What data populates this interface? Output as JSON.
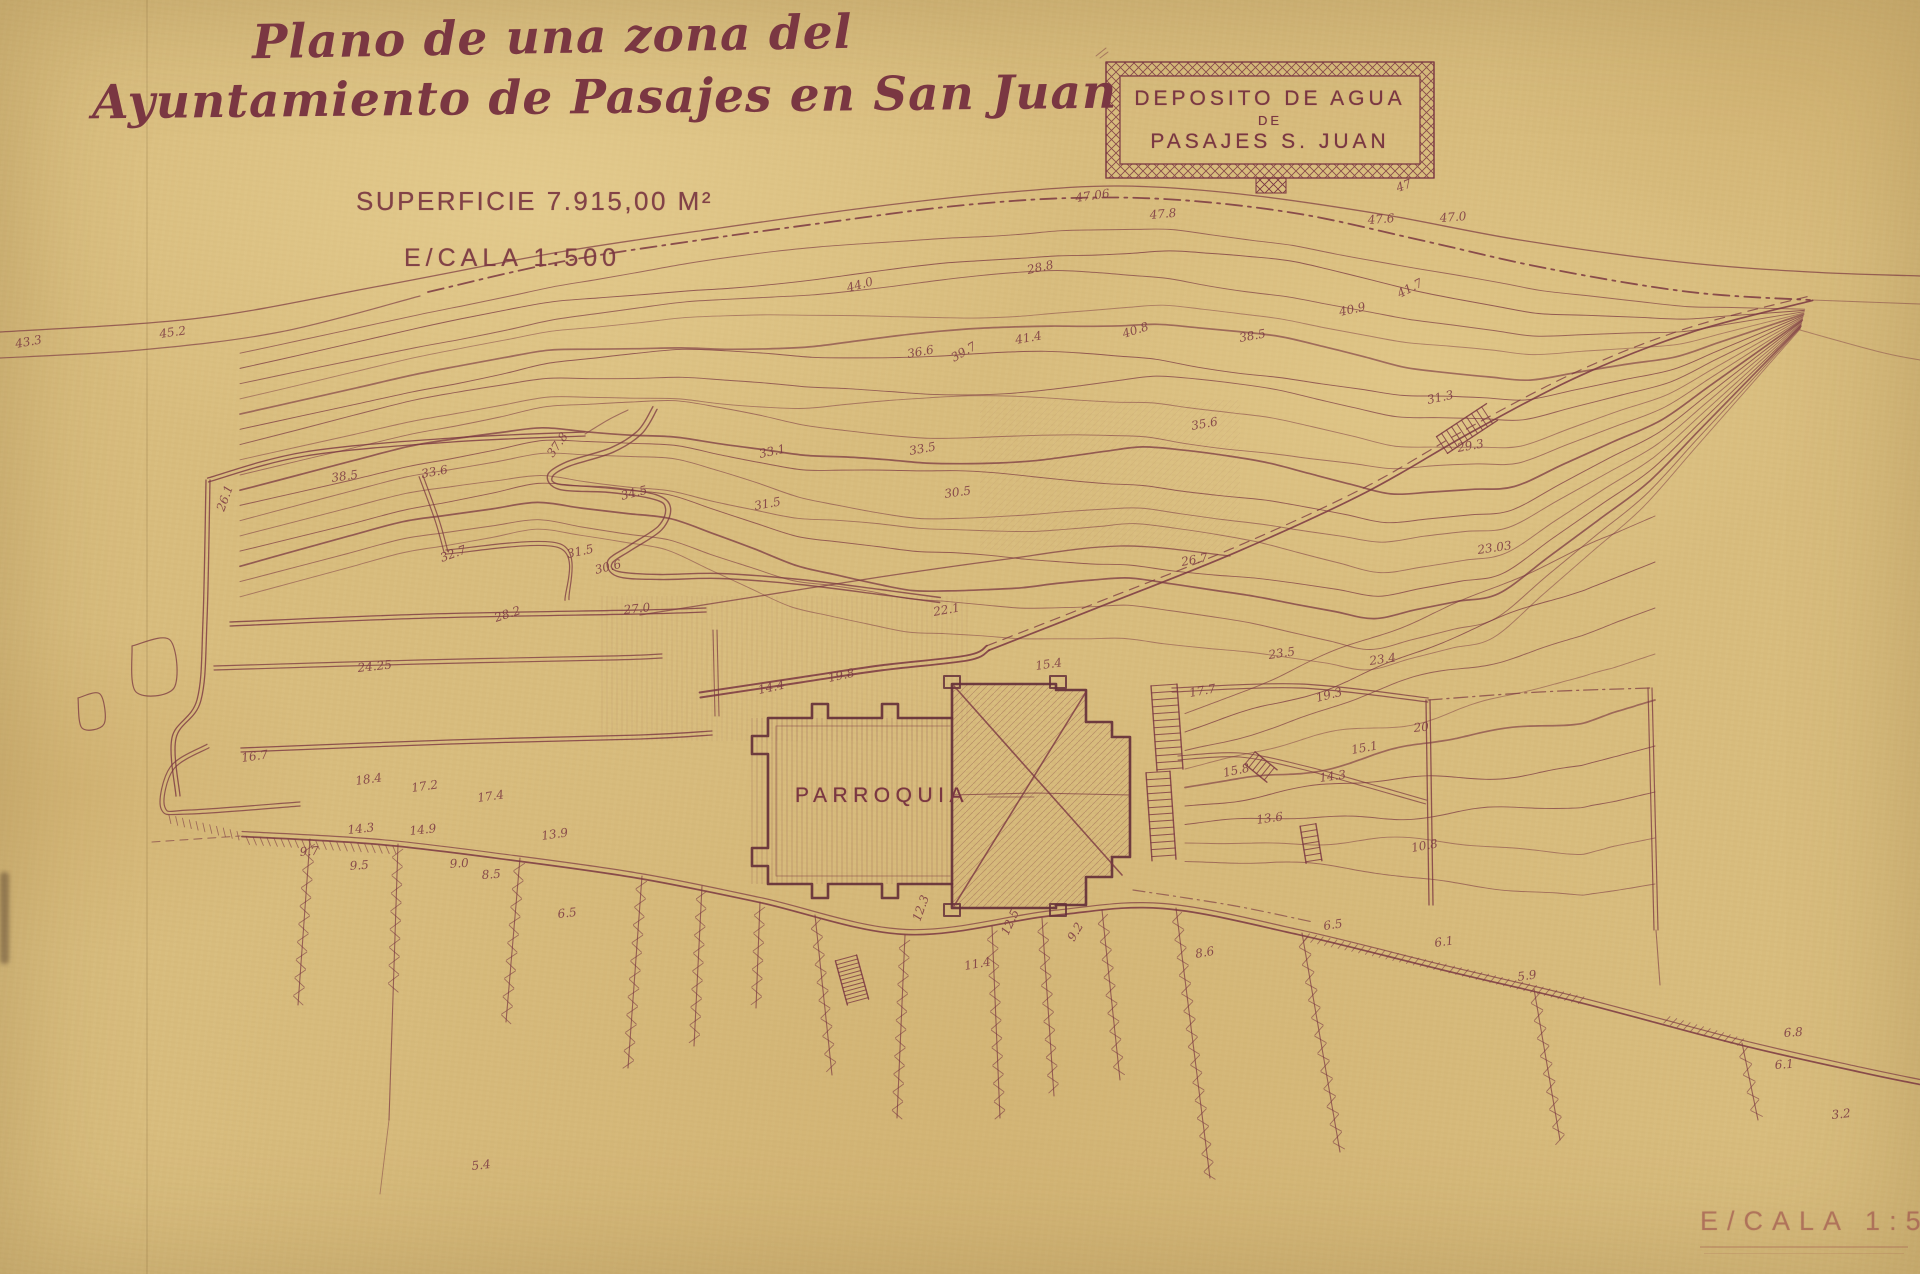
{
  "document": {
    "title_line1": "Plano de una zona del",
    "title_line2": "Ayuntamiento de Pasajes en San Juan",
    "superficie": "SUPERFICIE 7.915,00 M²",
    "escala": "E/CALA 1:500"
  },
  "deposito_box": {
    "line1": "DEPOSITO DE AGUA",
    "line2": "DE",
    "line3": "PASAJES S. JUAN"
  },
  "building_label": "PARROQUIA",
  "stamp": {
    "text": "E/CALA 1:5"
  },
  "colors": {
    "paper": "#d8bc7d",
    "ink": "#7a3742",
    "ink_dark": "#653039",
    "ink_faded": "#a25c50"
  },
  "spot_elevations": [
    [
      "45.2",
      160,
      338,
      -8
    ],
    [
      "43.3",
      16,
      348,
      -10
    ],
    [
      "44.0",
      848,
      292,
      -15
    ],
    [
      "47.06",
      1076,
      202,
      -8
    ],
    [
      "47.8",
      1150,
      219,
      -5
    ],
    [
      "28.8",
      1028,
      274,
      -12
    ],
    [
      "47.6",
      1368,
      224,
      -4
    ],
    [
      "47.0",
      1440,
      222,
      -4
    ],
    [
      "47",
      1398,
      192,
      -20
    ],
    [
      "41.7",
      1400,
      298,
      -28
    ],
    [
      "40.9",
      1340,
      316,
      -12
    ],
    [
      "38.5",
      1240,
      342,
      -10
    ],
    [
      "40.8",
      1124,
      338,
      -18
    ],
    [
      "41.4",
      1016,
      344,
      -10
    ],
    [
      "39.7",
      954,
      362,
      -30
    ],
    [
      "37.8",
      553,
      458,
      -55
    ],
    [
      "36.6",
      908,
      358,
      -10
    ],
    [
      "35.6",
      1192,
      430,
      -10
    ],
    [
      "34.5",
      622,
      500,
      -14
    ],
    [
      "33.1",
      760,
      458,
      -12
    ],
    [
      "33.5",
      910,
      455,
      -10
    ],
    [
      "31.5",
      755,
      510,
      -10
    ],
    [
      "30.5",
      945,
      498,
      -8
    ],
    [
      "33.6",
      422,
      478,
      -10
    ],
    [
      "38.5",
      332,
      482,
      -8
    ],
    [
      "32.7",
      442,
      562,
      -20
    ],
    [
      "31.5",
      568,
      558,
      -12
    ],
    [
      "30.6",
      596,
      574,
      -14
    ],
    [
      "28.2",
      496,
      622,
      -18
    ],
    [
      "26.1",
      224,
      512,
      -70
    ],
    [
      "27.0",
      624,
      614,
      -6
    ],
    [
      "22.1",
      934,
      616,
      -10
    ],
    [
      "23.03",
      1478,
      554,
      -8
    ],
    [
      "26.7",
      1182,
      566,
      -10
    ],
    [
      "31.3",
      1428,
      404,
      -12
    ],
    [
      "29.3",
      1458,
      452,
      -10
    ],
    [
      "24.25",
      358,
      672,
      -6
    ],
    [
      "16.7",
      242,
      762,
      -8
    ],
    [
      "18.4",
      356,
      785,
      -8
    ],
    [
      "17.2",
      412,
      792,
      -8
    ],
    [
      "17.4",
      478,
      802,
      -8
    ],
    [
      "14.3",
      348,
      834,
      -6
    ],
    [
      "14.9",
      410,
      835,
      -6
    ],
    [
      "13.9",
      542,
      840,
      -8
    ],
    [
      "9.7",
      300,
      856,
      -4
    ],
    [
      "9.5",
      350,
      870,
      -4
    ],
    [
      "9.0",
      450,
      868,
      -4
    ],
    [
      "8.5",
      482,
      879,
      -4
    ],
    [
      "6.5",
      558,
      918,
      -6
    ],
    [
      "12.3",
      920,
      922,
      -70
    ],
    [
      "12.5",
      1008,
      936,
      -65
    ],
    [
      "11.4",
      965,
      970,
      -10
    ],
    [
      "9.2",
      1074,
      942,
      -60
    ],
    [
      "8.6",
      1196,
      958,
      -10
    ],
    [
      "19.8",
      829,
      682,
      -12
    ],
    [
      "14.4",
      759,
      694,
      -12
    ],
    [
      "17.7",
      1190,
      697,
      -10
    ],
    [
      "23.5",
      1269,
      659,
      -8
    ],
    [
      "23.4",
      1370,
      665,
      -8
    ],
    [
      "19.3",
      1317,
      702,
      -14
    ],
    [
      "20",
      1414,
      732,
      -6
    ],
    [
      "15.1",
      1352,
      754,
      -10
    ],
    [
      "15.8",
      1224,
      777,
      -12
    ],
    [
      "14.3",
      1320,
      782,
      -8
    ],
    [
      "13.6",
      1257,
      824,
      -8
    ],
    [
      "10.8",
      1412,
      852,
      -10
    ],
    [
      "6.5",
      1324,
      930,
      -8
    ],
    [
      "6.1",
      1435,
      947,
      -8
    ],
    [
      "5.9",
      1518,
      981,
      -8
    ],
    [
      "6.8",
      1784,
      1037,
      -4
    ],
    [
      "6.1",
      1775,
      1069,
      -4
    ],
    [
      "3.2",
      1832,
      1119,
      -6
    ],
    [
      "5.4",
      472,
      1170,
      -6
    ],
    [
      "15.4",
      1036,
      670,
      -8
    ]
  ]
}
